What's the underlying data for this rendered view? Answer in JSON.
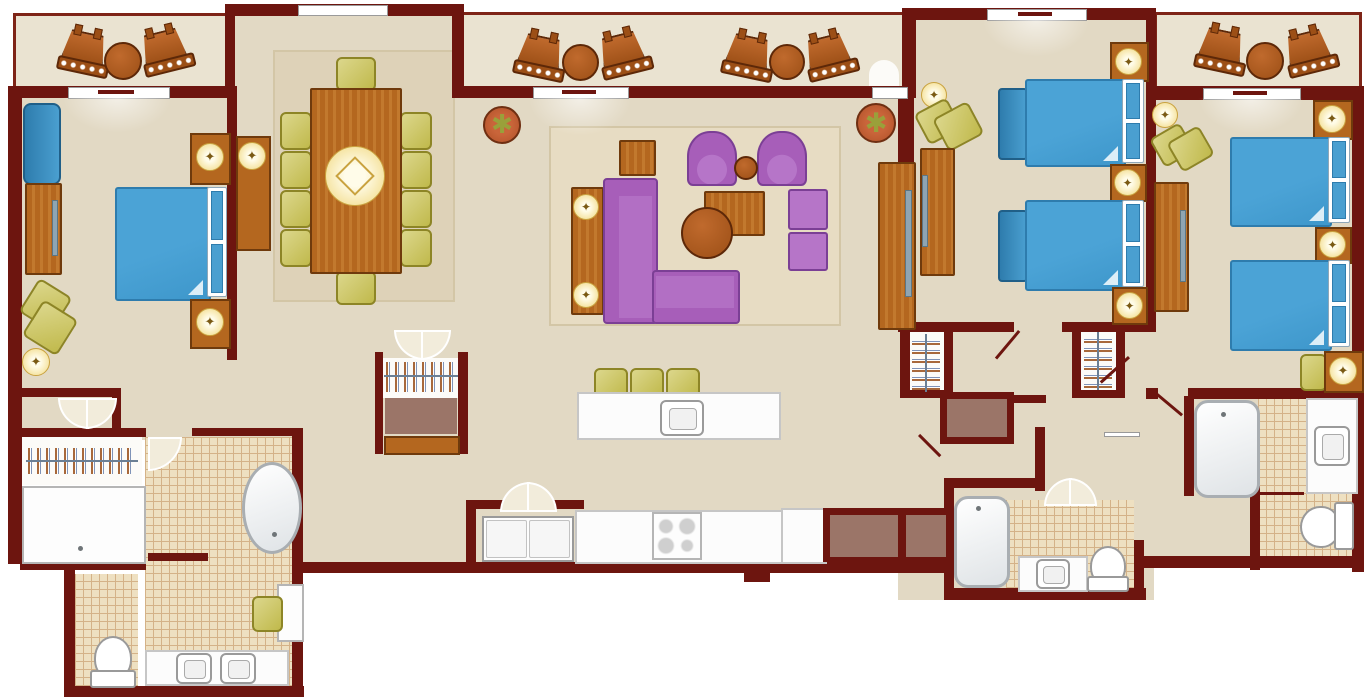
{
  "meta": {
    "title": "Three-bedroom villa floor plan",
    "view": "top-down architectural illustration",
    "visible_text": "none"
  },
  "palette": {
    "wall": "#6d150f",
    "wallLite": "#7e2417",
    "floor": "#e2d9c4",
    "balconyFloor": "#eae3d1",
    "rug": "#e7dcc3",
    "rugEdge": "#d3c6a6",
    "tile": "#eee0c1",
    "tileLine": "#d4b288",
    "wood": "#b4671f",
    "woodLite": "#c2792e",
    "woodDark": "#6f3a0c",
    "blue": "#4ba3d6",
    "blueDark": "#2e7cad",
    "green": "#c0b94b",
    "greenLite": "#dcd78c",
    "greenDark": "#8d8526",
    "purple": "#a75eb9",
    "purpleLite": "#b675c8",
    "purpleDark": "#7b3f95",
    "lampGlow": "#f5e3a0",
    "lampRim": "#c9a23f",
    "mauve": "#9b7568",
    "terracotta": "#b05028",
    "leaf": "#9aa03a"
  },
  "icons": {
    "lamp_star": "✦",
    "plant_leaves": "✱"
  },
  "rooms": [
    {
      "id": "balcony-left",
      "name": "balcony",
      "furniture": [
        "rocking-chair",
        "round-table",
        "rocking-chair"
      ]
    },
    {
      "id": "balcony-center",
      "name": "balcony",
      "furniture": [
        "rocking-chair",
        "round-table",
        "rocking-chair",
        "rocking-chair",
        "round-table",
        "rocking-chair"
      ]
    },
    {
      "id": "balcony-right",
      "name": "balcony",
      "furniture": [
        "rocking-chair",
        "round-table",
        "rocking-chair"
      ]
    },
    {
      "id": "master-bedroom",
      "name": "master bedroom",
      "furniture": [
        "king-bed",
        "headboard",
        "nightstand-lamp",
        "nightstand-lamp",
        "dresser-tv",
        "chaise",
        "armchair",
        "ceiling-light"
      ]
    },
    {
      "id": "dining-room",
      "name": "dining room",
      "furniture": [
        "area-rug",
        "dining-table",
        "lazy-susan",
        "dining-chair-x10",
        "buffet-lamp"
      ]
    },
    {
      "id": "living-room",
      "name": "living room",
      "furniture": [
        "area-rug",
        "sectional-sofa",
        "armchair",
        "armchair",
        "round-side-table",
        "coffee-table",
        "square-side-table",
        "end-table",
        "ottoman",
        "ottoman",
        "console-lamps",
        "media-console-tv",
        "potted-plant",
        "potted-plant"
      ]
    },
    {
      "id": "kitchen",
      "name": "kitchen",
      "furniture": [
        "island-with-sink",
        "barstool-x3",
        "range",
        "refrigerator",
        "counter"
      ]
    },
    {
      "id": "bedroom-2",
      "name": "bedroom 2",
      "furniture": [
        "queen-bed",
        "queen-bed",
        "bench",
        "bench",
        "nightstand-lamp-x3",
        "dresser-tv",
        "armchair",
        "ceiling-light",
        "closet"
      ]
    },
    {
      "id": "bedroom-3",
      "name": "bedroom 3",
      "furniture": [
        "queen-bed",
        "queen-bed",
        "nightstand-lamp-x3",
        "dresser-tv",
        "armchair",
        "bench",
        "ceiling-light",
        "closet"
      ]
    },
    {
      "id": "master-bathroom",
      "name": "master bathroom",
      "furniture": [
        "walk-in-closet",
        "shower",
        "soaking-tub",
        "double-vanity",
        "toilet",
        "bench"
      ]
    },
    {
      "id": "bathroom-2",
      "name": "bathroom 2",
      "furniture": [
        "tub",
        "vanity-sink",
        "toilet"
      ]
    },
    {
      "id": "bathroom-3",
      "name": "bathroom 3",
      "furniture": [
        "tub",
        "vanity-sink",
        "toilet"
      ]
    },
    {
      "id": "hall-closet",
      "name": "hall closet",
      "furniture": [
        "hanging-rod",
        "shelf",
        "bench"
      ]
    }
  ]
}
